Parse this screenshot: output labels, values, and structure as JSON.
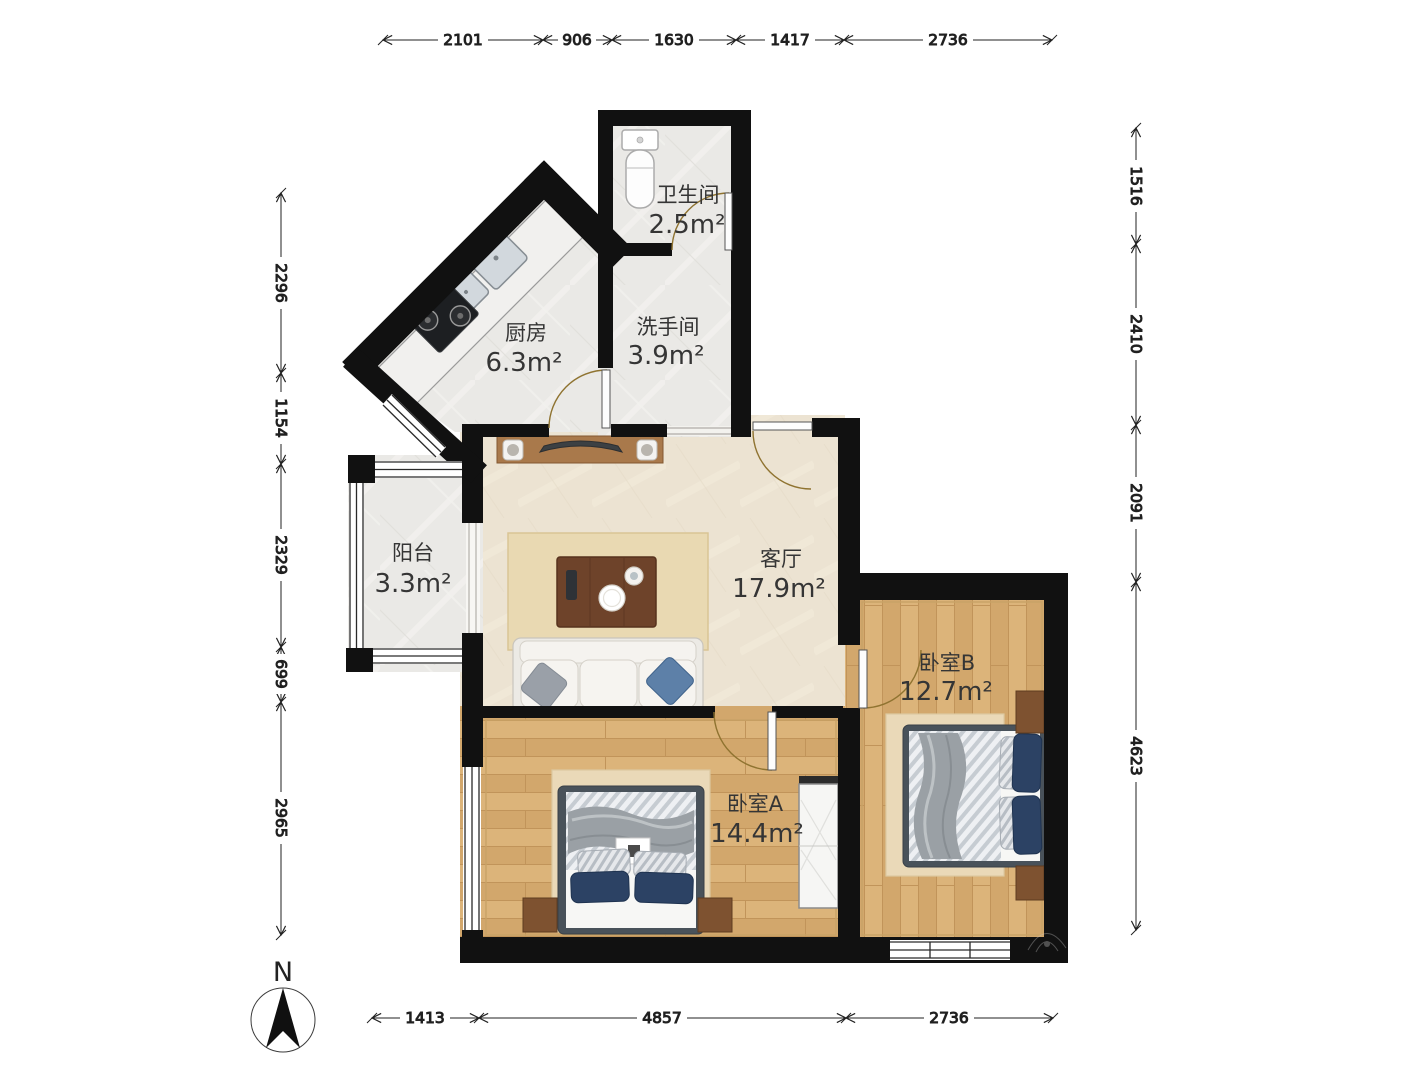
{
  "dims": {
    "top": [
      "2101",
      "906",
      "1630",
      "1417",
      "2736"
    ],
    "left": [
      "2296",
      "1154",
      "2329",
      "699",
      "2965"
    ],
    "right": [
      "1516",
      "2410",
      "2091",
      "4623"
    ],
    "bottom": [
      "1413",
      "4857",
      "2736"
    ]
  },
  "rooms": [
    {
      "name": "卫生间",
      "area": "2.5m²"
    },
    {
      "name": "厨房",
      "area": "6.3m²"
    },
    {
      "name": "洗手间",
      "area": "3.9m²"
    },
    {
      "name": "阳台",
      "area": "3.3m²"
    },
    {
      "name": "客厅",
      "area": "17.9m²"
    },
    {
      "name": "卧室B",
      "area": "12.7m²"
    },
    {
      "name": "卧室A",
      "area": "14.4m²"
    }
  ],
  "compass": {
    "north_label": "N"
  },
  "watermark": {
    "text": "贝壳找房"
  },
  "colors": {
    "wall": "#111111",
    "wood_floor": "#d8ae74",
    "tile_floor": "#eae9e6",
    "living_floor": "#ece3d2",
    "door_arc": "#8f7330",
    "bed_frame": "#49525a",
    "navy_pillow": "#2c4264",
    "rug": "#ead9b8",
    "dim_line": "#222222"
  }
}
